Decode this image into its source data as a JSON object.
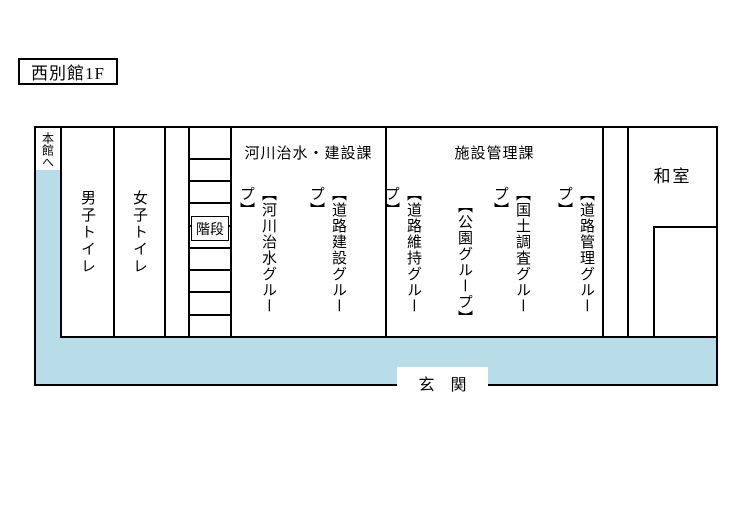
{
  "title": "西別館1F",
  "colors": {
    "corridor_blue": "#b8dde8",
    "line": "#000000"
  },
  "plan": {
    "to_main_building": "本館へ",
    "rooms": {
      "mens_toilet": "男子トイレ",
      "womens_toilet": "女子トイレ",
      "stairs": "階段",
      "river_division": {
        "name": "河川治水・建設課",
        "groups": [
          "【河川治水グループ】",
          "【道路建設グループ】"
        ]
      },
      "facility_division": {
        "name": "施設管理課",
        "groups": [
          "【道路維持グループ】",
          "【公園グループ】",
          "【国土調査グループ】",
          "【道路管理グループ】"
        ]
      },
      "japanese_room": "和室",
      "entrance": "玄　関"
    }
  }
}
